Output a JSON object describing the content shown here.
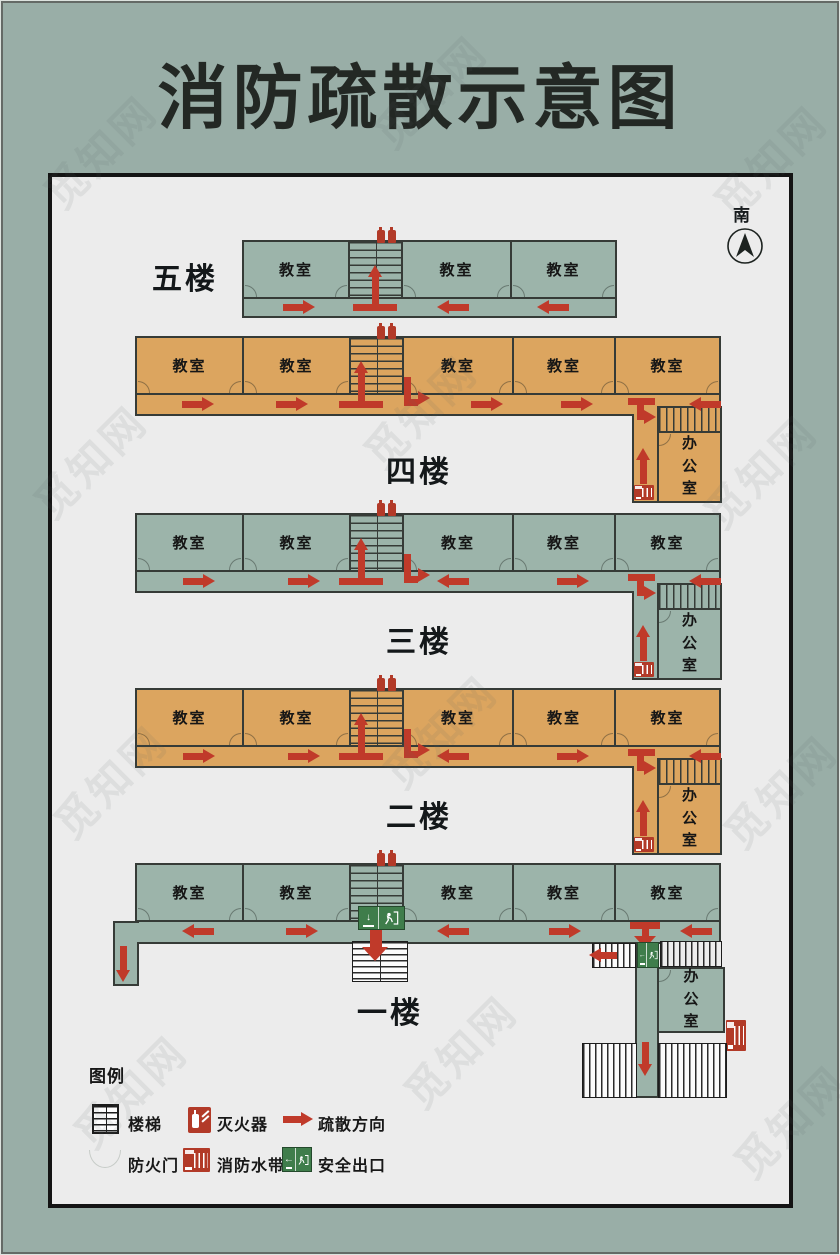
{
  "title": "消防疏散示意图",
  "compass": {
    "label": "南"
  },
  "floors": [
    {
      "name": "五楼",
      "rooms": [
        "教室",
        "教室",
        "教室"
      ]
    },
    {
      "name": "四楼",
      "rooms": [
        "教室",
        "教室",
        "教室",
        "教室",
        "教室"
      ],
      "office": "办公室"
    },
    {
      "name": "三楼",
      "rooms": [
        "教室",
        "教室",
        "教室",
        "教室",
        "教室"
      ],
      "office": "办公室"
    },
    {
      "name": "二楼",
      "rooms": [
        "教室",
        "教室",
        "教室",
        "教室",
        "教室"
      ],
      "office": "办公室"
    },
    {
      "name": "一楼",
      "rooms": [
        "教室",
        "教室",
        "教室",
        "教室",
        "教室"
      ],
      "office": "办公室"
    }
  ],
  "legend": {
    "title": "图例",
    "stairs": "楼梯",
    "extinguisher": "灭火器",
    "direction": "疏散方向",
    "fire_door": "防火门",
    "fire_hose": "消防水带",
    "exit": "安全出口"
  },
  "exit_sign": {
    "down_arrow": "↓",
    "left_arrow": "←"
  },
  "watermark": "觅知网",
  "colors": {
    "page_background": "#99aea7",
    "panel_background": "#ececec",
    "green_floor": "#9cb4aa",
    "orange_floor": "#dca55f",
    "wall": "#363b37",
    "arrow_red": "#c03a2a",
    "icon_red": "#b23a28",
    "exit_green": "#3f7d4b"
  }
}
